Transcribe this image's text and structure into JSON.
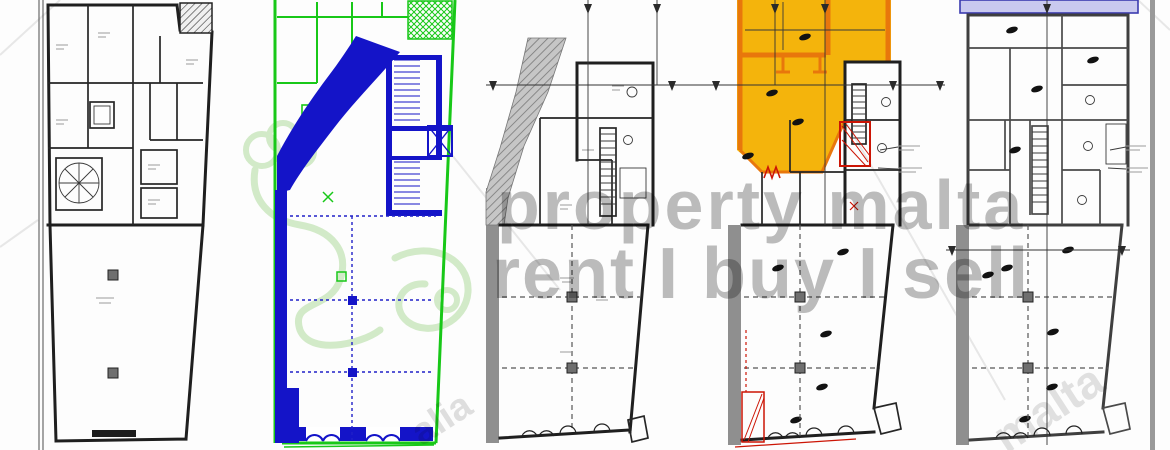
{
  "watermark": {
    "line1": "property malta",
    "line2": "rent I buy I sell",
    "diagonal_text_center": "alia",
    "diagonal_text_right": "malta"
  },
  "colors": {
    "plan_ink": "#1f1f1f",
    "existing_green": "#18c818",
    "demolition_blue": "#1414c8",
    "masonry_grey": "#8f8f8f",
    "highlight_amber": "#f4b40c",
    "highlight_orange": "#e8770c",
    "annotation_red": "#cc1505",
    "band_lavender": "#c9c9ef",
    "watermark_grey": "#b5b5b5",
    "logo_green": "#d2eac8"
  },
  "panels": [
    {
      "position": 1,
      "palette": "black ink"
    },
    {
      "position": 2,
      "palette": "green with blue"
    },
    {
      "position": 3,
      "palette": "grey ink with hatching"
    },
    {
      "position": 4,
      "palette": "amber, orange and red"
    },
    {
      "position": 5,
      "palette": "grey ink with blue band"
    }
  ]
}
